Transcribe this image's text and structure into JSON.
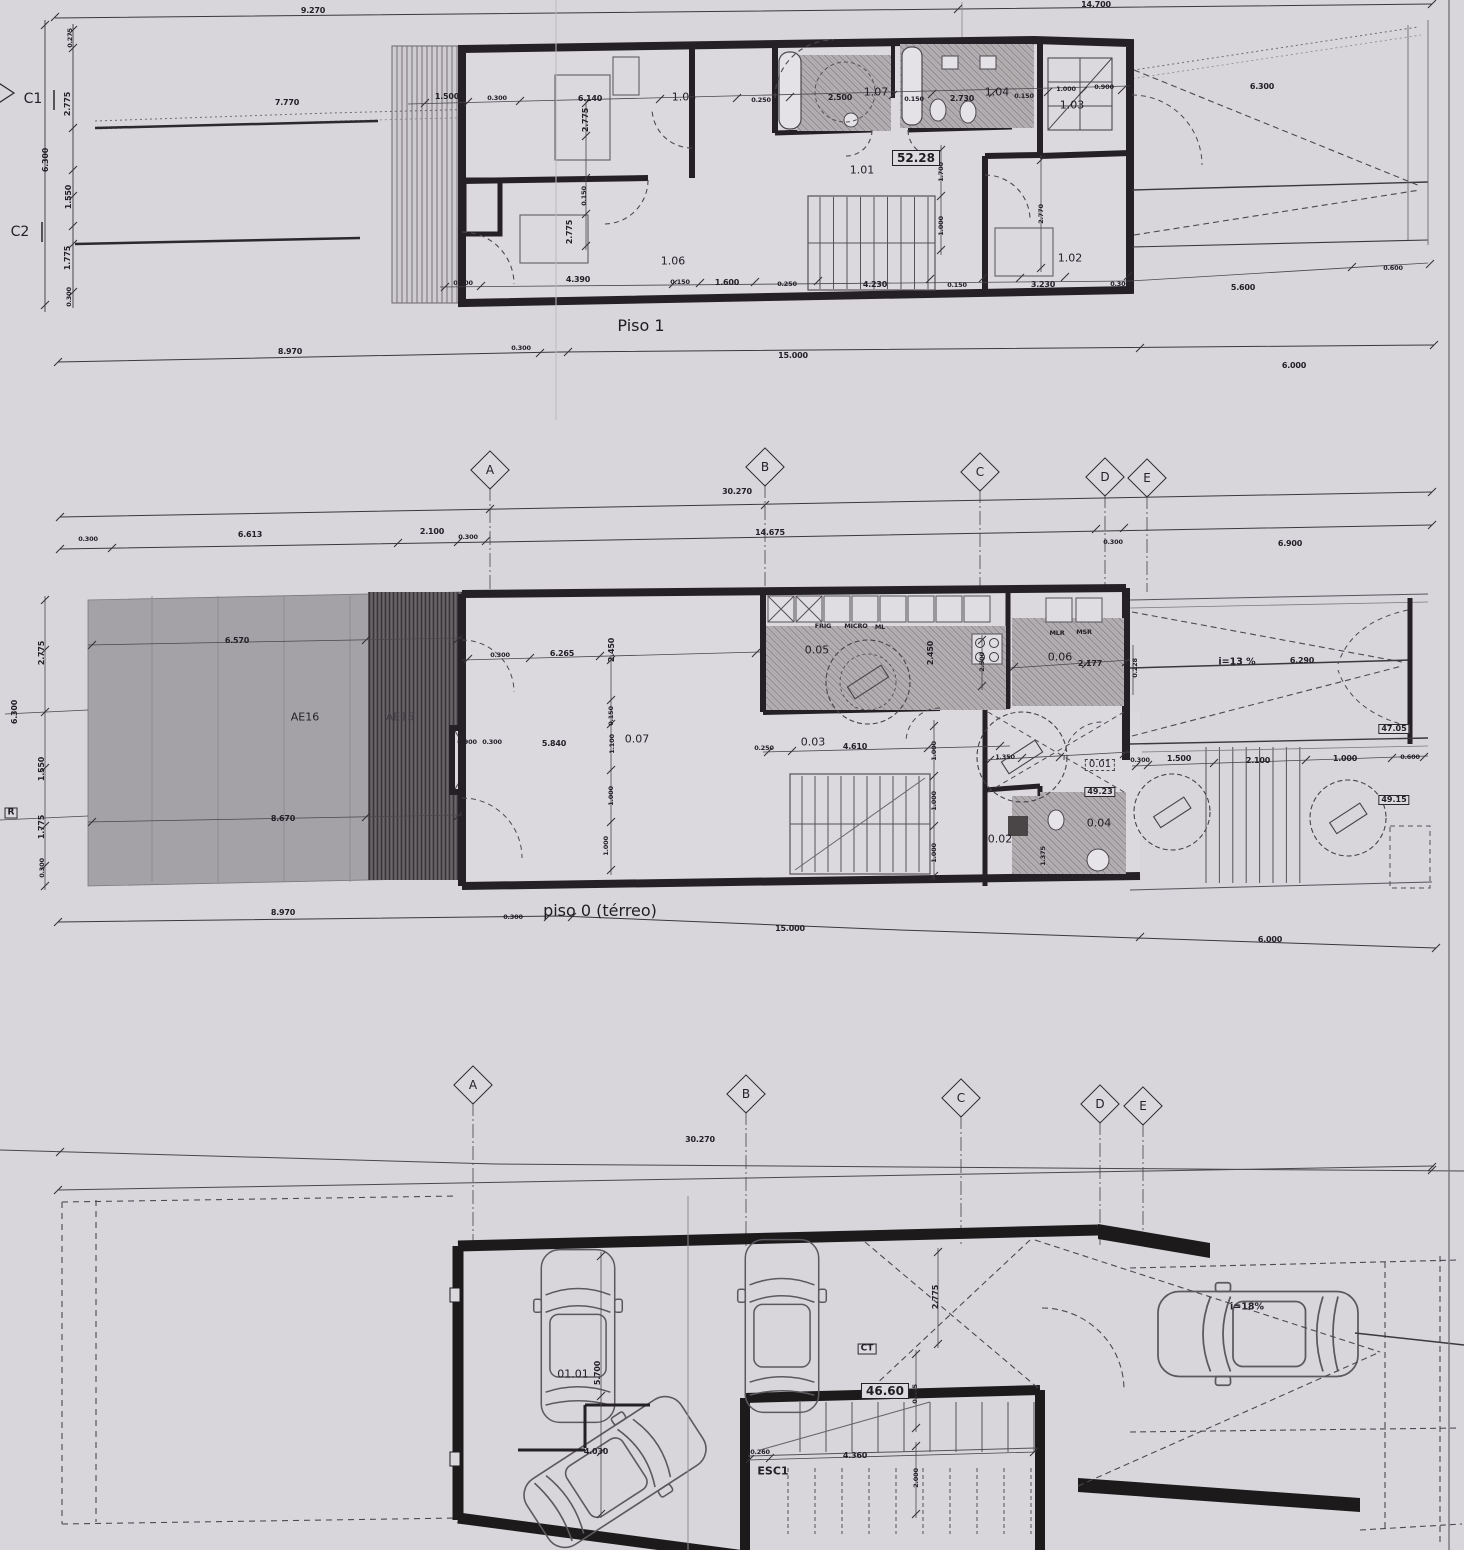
{
  "palette": {
    "paper": "#d8d6db",
    "ink": "#242026",
    "patio_fill": "#a5a2a7",
    "hatch_fill": "#b6b2b5"
  },
  "labels": {
    "piso1_title": "Piso 1",
    "piso0_title": "piso 0 (térreo)",
    "piso1_area": "52.28",
    "garage_area": "46.60",
    "marker_c1": "C1",
    "marker_c2": "C2",
    "marker_r": "R",
    "ct": "CT",
    "esc1": "ESC1"
  },
  "grid": {
    "letters": [
      "A",
      "B",
      "C",
      "D",
      "E"
    ],
    "bands": [
      {
        "positions": [
          [
            490,
            470
          ],
          [
            765,
            467
          ],
          [
            980,
            472
          ],
          [
            1105,
            477
          ],
          [
            1147,
            478
          ]
        ]
      },
      {
        "positions": [
          [
            473,
            1085
          ],
          [
            746,
            1094
          ],
          [
            961,
            1098
          ],
          [
            1100,
            1104
          ],
          [
            1143,
            1106
          ]
        ]
      }
    ]
  },
  "annotations": [
    {
      "t": "9.270",
      "x": 313,
      "y": 11
    },
    {
      "t": "14.700",
      "x": 1096,
      "y": 5
    },
    {
      "t": "7.770",
      "x": 287,
      "y": 103
    },
    {
      "t": "1.500",
      "x": 447,
      "y": 97
    },
    {
      "t": "0.300",
      "x": 497,
      "y": 98,
      "v": "t"
    },
    {
      "t": "6.140",
      "x": 590,
      "y": 99
    },
    {
      "t": "1.05",
      "x": 684,
      "y": 97,
      "v": "r"
    },
    {
      "t": "0.250",
      "x": 761,
      "y": 100,
      "v": "t"
    },
    {
      "t": "2.500",
      "x": 840,
      "y": 98
    },
    {
      "t": "1.07",
      "x": 876,
      "y": 92,
      "v": "r"
    },
    {
      "t": "0.150",
      "x": 914,
      "y": 99,
      "v": "t"
    },
    {
      "t": "2.730",
      "x": 962,
      "y": 99
    },
    {
      "t": "1.04",
      "x": 997,
      "y": 92,
      "v": "r"
    },
    {
      "t": "0.150",
      "x": 1024,
      "y": 96,
      "v": "t"
    },
    {
      "t": "1.000",
      "x": 1066,
      "y": 89,
      "v": "t"
    },
    {
      "t": "0.900",
      "x": 1104,
      "y": 87,
      "v": "t"
    },
    {
      "t": "1.03",
      "x": 1072,
      "y": 105,
      "v": "r"
    },
    {
      "t": "6.300",
      "x": 1262,
      "y": 87
    },
    {
      "t": "1.01",
      "x": 862,
      "y": 170,
      "v": "r"
    },
    {
      "t": "2.775",
      "x": 586,
      "y": 120,
      "r": 1
    },
    {
      "t": "0.150",
      "x": 584,
      "y": 196,
      "r": 1,
      "v": "t"
    },
    {
      "t": "2.775",
      "x": 570,
      "y": 232,
      "r": 1
    },
    {
      "t": "1.700",
      "x": 941,
      "y": 172,
      "r": 1,
      "v": "t"
    },
    {
      "t": "1.000",
      "x": 941,
      "y": 226,
      "r": 1,
      "v": "t"
    },
    {
      "t": "2.770",
      "x": 1041,
      "y": 214,
      "r": 1,
      "v": "t"
    },
    {
      "t": "1.02",
      "x": 1070,
      "y": 258,
      "v": "r"
    },
    {
      "t": "1.06",
      "x": 673,
      "y": 261,
      "v": "r"
    },
    {
      "t": "0.300",
      "x": 463,
      "y": 283,
      "v": "t"
    },
    {
      "t": "4.390",
      "x": 578,
      "y": 280
    },
    {
      "t": "0.150",
      "x": 680,
      "y": 282,
      "v": "t"
    },
    {
      "t": "1.600",
      "x": 727,
      "y": 283
    },
    {
      "t": "0.250",
      "x": 787,
      "y": 284,
      "v": "t"
    },
    {
      "t": "4.230",
      "x": 875,
      "y": 285
    },
    {
      "t": "0.150",
      "x": 957,
      "y": 285,
      "v": "t"
    },
    {
      "t": "3.230",
      "x": 1043,
      "y": 285
    },
    {
      "t": "0.300",
      "x": 1120,
      "y": 284,
      "v": "t"
    },
    {
      "t": "5.600",
      "x": 1243,
      "y": 288
    },
    {
      "t": "0.600",
      "x": 1393,
      "y": 268,
      "v": "t"
    },
    {
      "t": "0.275",
      "x": 70,
      "y": 38,
      "r": 1,
      "v": "t"
    },
    {
      "t": "2.775",
      "x": 68,
      "y": 104,
      "r": 1
    },
    {
      "t": "6.300",
      "x": 46,
      "y": 160,
      "r": 1
    },
    {
      "t": "1.550",
      "x": 69,
      "y": 197,
      "r": 1
    },
    {
      "t": "1.775",
      "x": 68,
      "y": 258,
      "r": 1
    },
    {
      "t": "0.300",
      "x": 69,
      "y": 297,
      "r": 1,
      "v": "t"
    },
    {
      "t": "8.970",
      "x": 290,
      "y": 352
    },
    {
      "t": "0.300",
      "x": 521,
      "y": 348,
      "v": "t"
    },
    {
      "t": "15.000",
      "x": 793,
      "y": 356
    },
    {
      "t": "6.000",
      "x": 1294,
      "y": 366
    },
    {
      "t": "30.270",
      "x": 737,
      "y": 492
    },
    {
      "t": "0.300",
      "x": 88,
      "y": 539,
      "v": "t"
    },
    {
      "t": "6.613",
      "x": 250,
      "y": 535
    },
    {
      "t": "2.100",
      "x": 432,
      "y": 532
    },
    {
      "t": "0.300",
      "x": 468,
      "y": 537,
      "v": "t"
    },
    {
      "t": "14.675",
      "x": 770,
      "y": 533
    },
    {
      "t": "0.300",
      "x": 1113,
      "y": 542,
      "v": "t"
    },
    {
      "t": "6.900",
      "x": 1290,
      "y": 544
    },
    {
      "t": "6.570",
      "x": 237,
      "y": 641
    },
    {
      "t": "AE16",
      "x": 305,
      "y": 717,
      "v": "r"
    },
    {
      "t": "AE15",
      "x": 400,
      "y": 717,
      "v": "rl"
    },
    {
      "t": "8.670",
      "x": 283,
      "y": 819
    },
    {
      "t": "0.900",
      "x": 467,
      "y": 742,
      "v": "t"
    },
    {
      "t": "0.300",
      "x": 492,
      "y": 742,
      "v": "t"
    },
    {
      "t": "0.300",
      "x": 500,
      "y": 655,
      "v": "t"
    },
    {
      "t": "6.265",
      "x": 562,
      "y": 654
    },
    {
      "t": "2.450",
      "x": 612,
      "y": 650,
      "r": 1
    },
    {
      "t": "0.150",
      "x": 611,
      "y": 716,
      "r": 1,
      "v": "t"
    },
    {
      "t": "5.840",
      "x": 554,
      "y": 744
    },
    {
      "t": "1.100",
      "x": 612,
      "y": 744,
      "r": 1,
      "v": "t"
    },
    {
      "t": "0.07",
      "x": 637,
      "y": 739,
      "v": "r"
    },
    {
      "t": "1.000",
      "x": 611,
      "y": 796,
      "r": 1,
      "v": "t"
    },
    {
      "t": "1.000",
      "x": 606,
      "y": 846,
      "r": 1,
      "v": "t"
    },
    {
      "t": "0.05",
      "x": 817,
      "y": 650,
      "v": "r"
    },
    {
      "t": "FRIG",
      "x": 823,
      "y": 626,
      "v": "t"
    },
    {
      "t": "MICRO",
      "x": 856,
      "y": 626,
      "v": "t"
    },
    {
      "t": "ML",
      "x": 880,
      "y": 627,
      "v": "t"
    },
    {
      "t": "2.450",
      "x": 931,
      "y": 653,
      "r": 1
    },
    {
      "t": "2.500",
      "x": 982,
      "y": 662,
      "r": 1,
      "v": "t"
    },
    {
      "t": "0.06",
      "x": 1060,
      "y": 657,
      "v": "r"
    },
    {
      "t": "MLR",
      "x": 1057,
      "y": 633,
      "v": "t"
    },
    {
      "t": "MSR",
      "x": 1084,
      "y": 632,
      "v": "t"
    },
    {
      "t": "2.177",
      "x": 1090,
      "y": 664
    },
    {
      "t": "0.228",
      "x": 1135,
      "y": 668,
      "r": 1,
      "v": "t"
    },
    {
      "t": "0.03",
      "x": 813,
      "y": 742,
      "v": "r"
    },
    {
      "t": "4.610",
      "x": 855,
      "y": 747
    },
    {
      "t": "0.250",
      "x": 764,
      "y": 748,
      "v": "t"
    },
    {
      "t": "1.000",
      "x": 934,
      "y": 751,
      "r": 1,
      "v": "t"
    },
    {
      "t": "1.000",
      "x": 934,
      "y": 801,
      "r": 1,
      "v": "t"
    },
    {
      "t": "1.000",
      "x": 934,
      "y": 853,
      "r": 1,
      "v": "t"
    },
    {
      "t": "1.350",
      "x": 1005,
      "y": 757,
      "v": "t"
    },
    {
      "t": "0.01",
      "x": 1100,
      "y": 765,
      "v": "db"
    },
    {
      "t": "49.23",
      "x": 1100,
      "y": 792,
      "v": "bx"
    },
    {
      "t": "0.04",
      "x": 1099,
      "y": 823,
      "v": "r"
    },
    {
      "t": "0.02",
      "x": 1000,
      "y": 839,
      "v": "r"
    },
    {
      "t": "1.375",
      "x": 1043,
      "y": 856,
      "r": 1,
      "v": "t"
    },
    {
      "t": "i=13 %",
      "x": 1237,
      "y": 662,
      "v": "r9"
    },
    {
      "t": "6.290",
      "x": 1302,
      "y": 661
    },
    {
      "t": "47.05",
      "x": 1394,
      "y": 729,
      "v": "bx"
    },
    {
      "t": "0.300",
      "x": 1140,
      "y": 760,
      "v": "t"
    },
    {
      "t": "1.500",
      "x": 1179,
      "y": 759
    },
    {
      "t": "2.100",
      "x": 1258,
      "y": 761
    },
    {
      "t": "1.000",
      "x": 1345,
      "y": 759
    },
    {
      "t": "0.600",
      "x": 1410,
      "y": 757,
      "v": "t"
    },
    {
      "t": "49.15",
      "x": 1394,
      "y": 800,
      "v": "bx"
    },
    {
      "t": "2.775",
      "x": 42,
      "y": 653,
      "r": 1
    },
    {
      "t": "6.300",
      "x": 15,
      "y": 712,
      "r": 1
    },
    {
      "t": "1.550",
      "x": 42,
      "y": 769,
      "r": 1
    },
    {
      "t": "1.775",
      "x": 42,
      "y": 827,
      "r": 1
    },
    {
      "t": "0.300",
      "x": 42,
      "y": 868,
      "r": 1,
      "v": "t"
    },
    {
      "t": "8.970",
      "x": 283,
      "y": 913
    },
    {
      "t": "0.300",
      "x": 513,
      "y": 917,
      "v": "t"
    },
    {
      "t": "15.000",
      "x": 790,
      "y": 929
    },
    {
      "t": "6.000",
      "x": 1270,
      "y": 940
    },
    {
      "t": "30.270",
      "x": 700,
      "y": 1140
    },
    {
      "t": "01.01",
      "x": 573,
      "y": 1374,
      "v": "r"
    },
    {
      "t": "5.700",
      "x": 598,
      "y": 1373,
      "r": 1
    },
    {
      "t": "4.030",
      "x": 596,
      "y": 1452
    },
    {
      "t": "0.775",
      "x": 915,
      "y": 1394,
      "r": 1,
      "v": "t"
    },
    {
      "t": "2.775",
      "x": 936,
      "y": 1297,
      "r": 1
    },
    {
      "t": "0.260",
      "x": 760,
      "y": 1452,
      "v": "t"
    },
    {
      "t": "4.360",
      "x": 855,
      "y": 1456
    },
    {
      "t": "2.000",
      "x": 916,
      "y": 1478,
      "r": 1,
      "v": "t"
    },
    {
      "t": "i=18%",
      "x": 1247,
      "y": 1307,
      "v": "r9"
    }
  ]
}
